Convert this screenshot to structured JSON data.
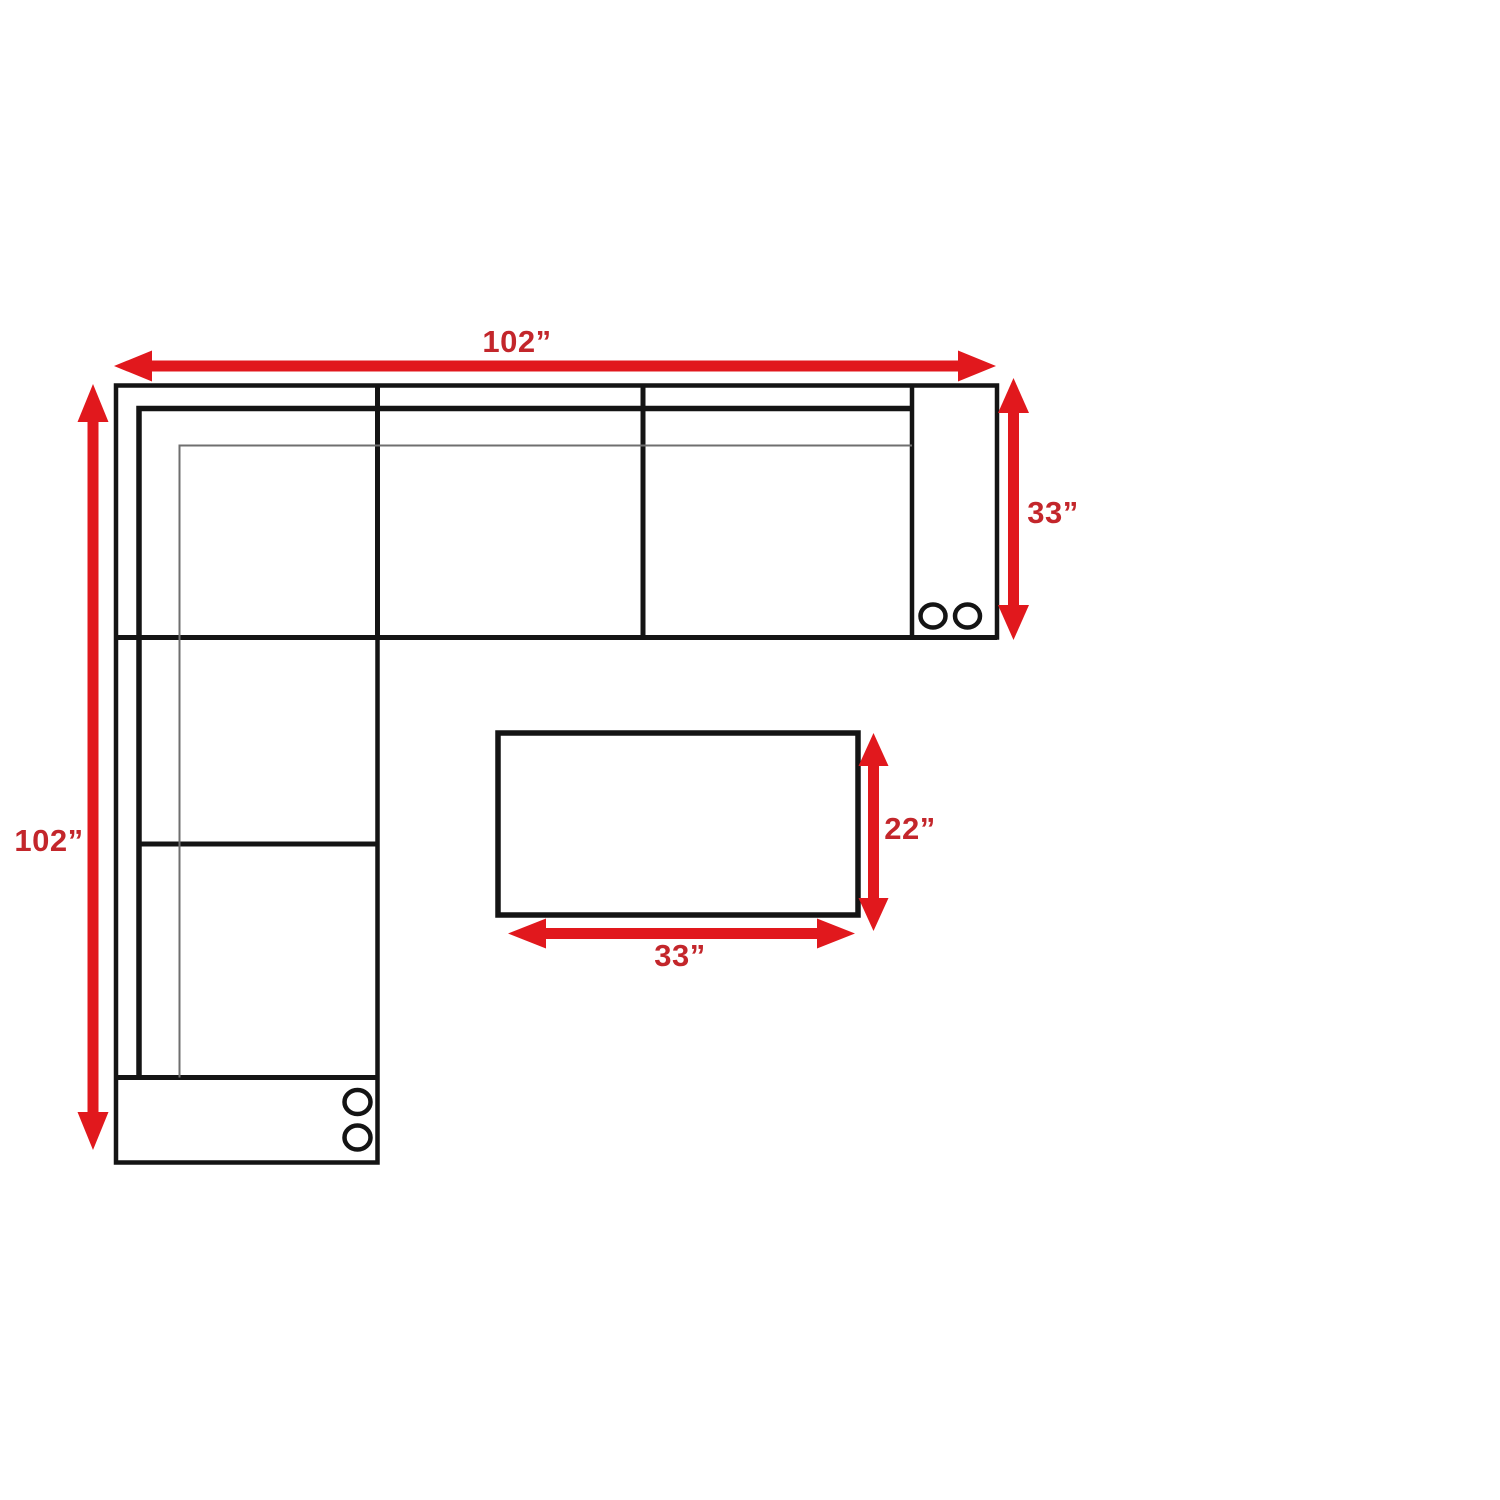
{
  "diagram": {
    "type": "sectional-sofa-dimension-plan",
    "view": "top-down floor plan",
    "unit": "inches",
    "background": "#ffffff"
  },
  "colors": {
    "arrow": "#e1181d",
    "label": "#c3262b",
    "outline": "#141414",
    "thin_line": "#6f6f6f",
    "fill": "#ffffff"
  },
  "sectional": {
    "overall_width_in": 102,
    "overall_depth_in": 102,
    "arm_section_depth_in": 33,
    "labels": {
      "overall_width": "102”",
      "overall_depth": "102”",
      "arm_section_depth": "33”"
    }
  },
  "ottoman": {
    "width_in": 33,
    "depth_in": 22,
    "labels": {
      "width": "33”",
      "depth": "22”"
    }
  }
}
